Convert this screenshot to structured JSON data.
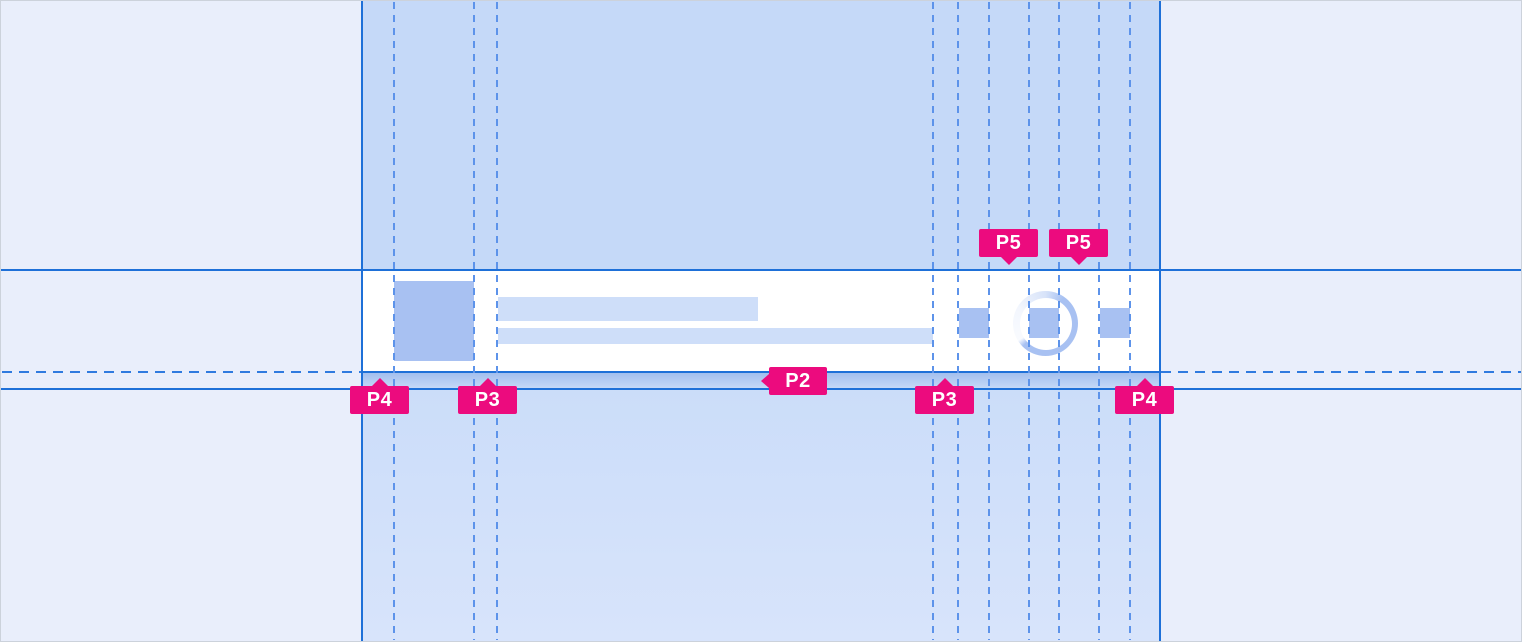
{
  "colors": {
    "page-bg": "#e9eefb",
    "page-border": "#ccd2db",
    "band-top-bg": "#c5d9f8",
    "band-bottom-from": "#cbddf9",
    "band-bottom-to": "#d8e4fb",
    "row-bg": "#ffffff",
    "shadow-from": "#a3bfee",
    "shadow-to": "#c7daf8",
    "placeholder-strong": "#a8c1f2",
    "placeholder-soft": "#cedef9",
    "line-solid": "#1e70d8",
    "line-dash-h": "#2f7adf",
    "line-dash-v": "#5d93ea",
    "tag-bg": "#ec0b7e",
    "tag-text-color": "#ffffff"
  },
  "component": {
    "avatar": "avatar-placeholder",
    "title_line": "title-line-placeholder",
    "subtitle_line": "subtitle-line-placeholder",
    "trailing_icons": [
      "icon-placeholder-square",
      "icon-placeholder-square",
      "icon-placeholder-square"
    ],
    "spinner": "progress-spinner"
  },
  "annotations": {
    "tags": [
      {
        "label": "P5",
        "direction": "down"
      },
      {
        "label": "P5",
        "direction": "down"
      },
      {
        "label": "P2",
        "direction": "left"
      },
      {
        "label": "P4",
        "direction": "up"
      },
      {
        "label": "P3",
        "direction": "up"
      },
      {
        "label": "P3",
        "direction": "up"
      },
      {
        "label": "P4",
        "direction": "up"
      }
    ]
  }
}
